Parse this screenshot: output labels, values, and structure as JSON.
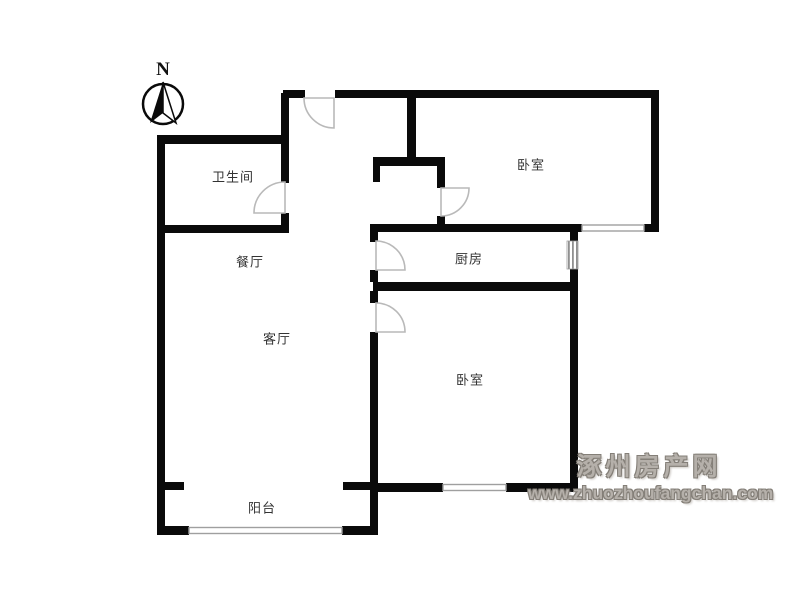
{
  "compass": {
    "label": "N"
  },
  "rooms": {
    "bathroom": {
      "label": "卫生间"
    },
    "dining": {
      "label": "餐厅"
    },
    "living": {
      "label": "客厅"
    },
    "kitchen": {
      "label": "厨房"
    },
    "bedroom_top": {
      "label": "卧室"
    },
    "bedroom_bottom": {
      "label": "卧室"
    },
    "balcony": {
      "label": "阳台"
    }
  },
  "watermark": {
    "line1": "涿州房产网",
    "line2": "www.zhuozhoufangchan.com"
  },
  "colors": {
    "background": "#ffffff",
    "wall": "#0a0a0a",
    "door": "#b9b9b9",
    "window": "#9f9f9f",
    "label": "#333333",
    "watermark_fill": "#b5b0aa",
    "watermark_outline": "#847f78"
  }
}
